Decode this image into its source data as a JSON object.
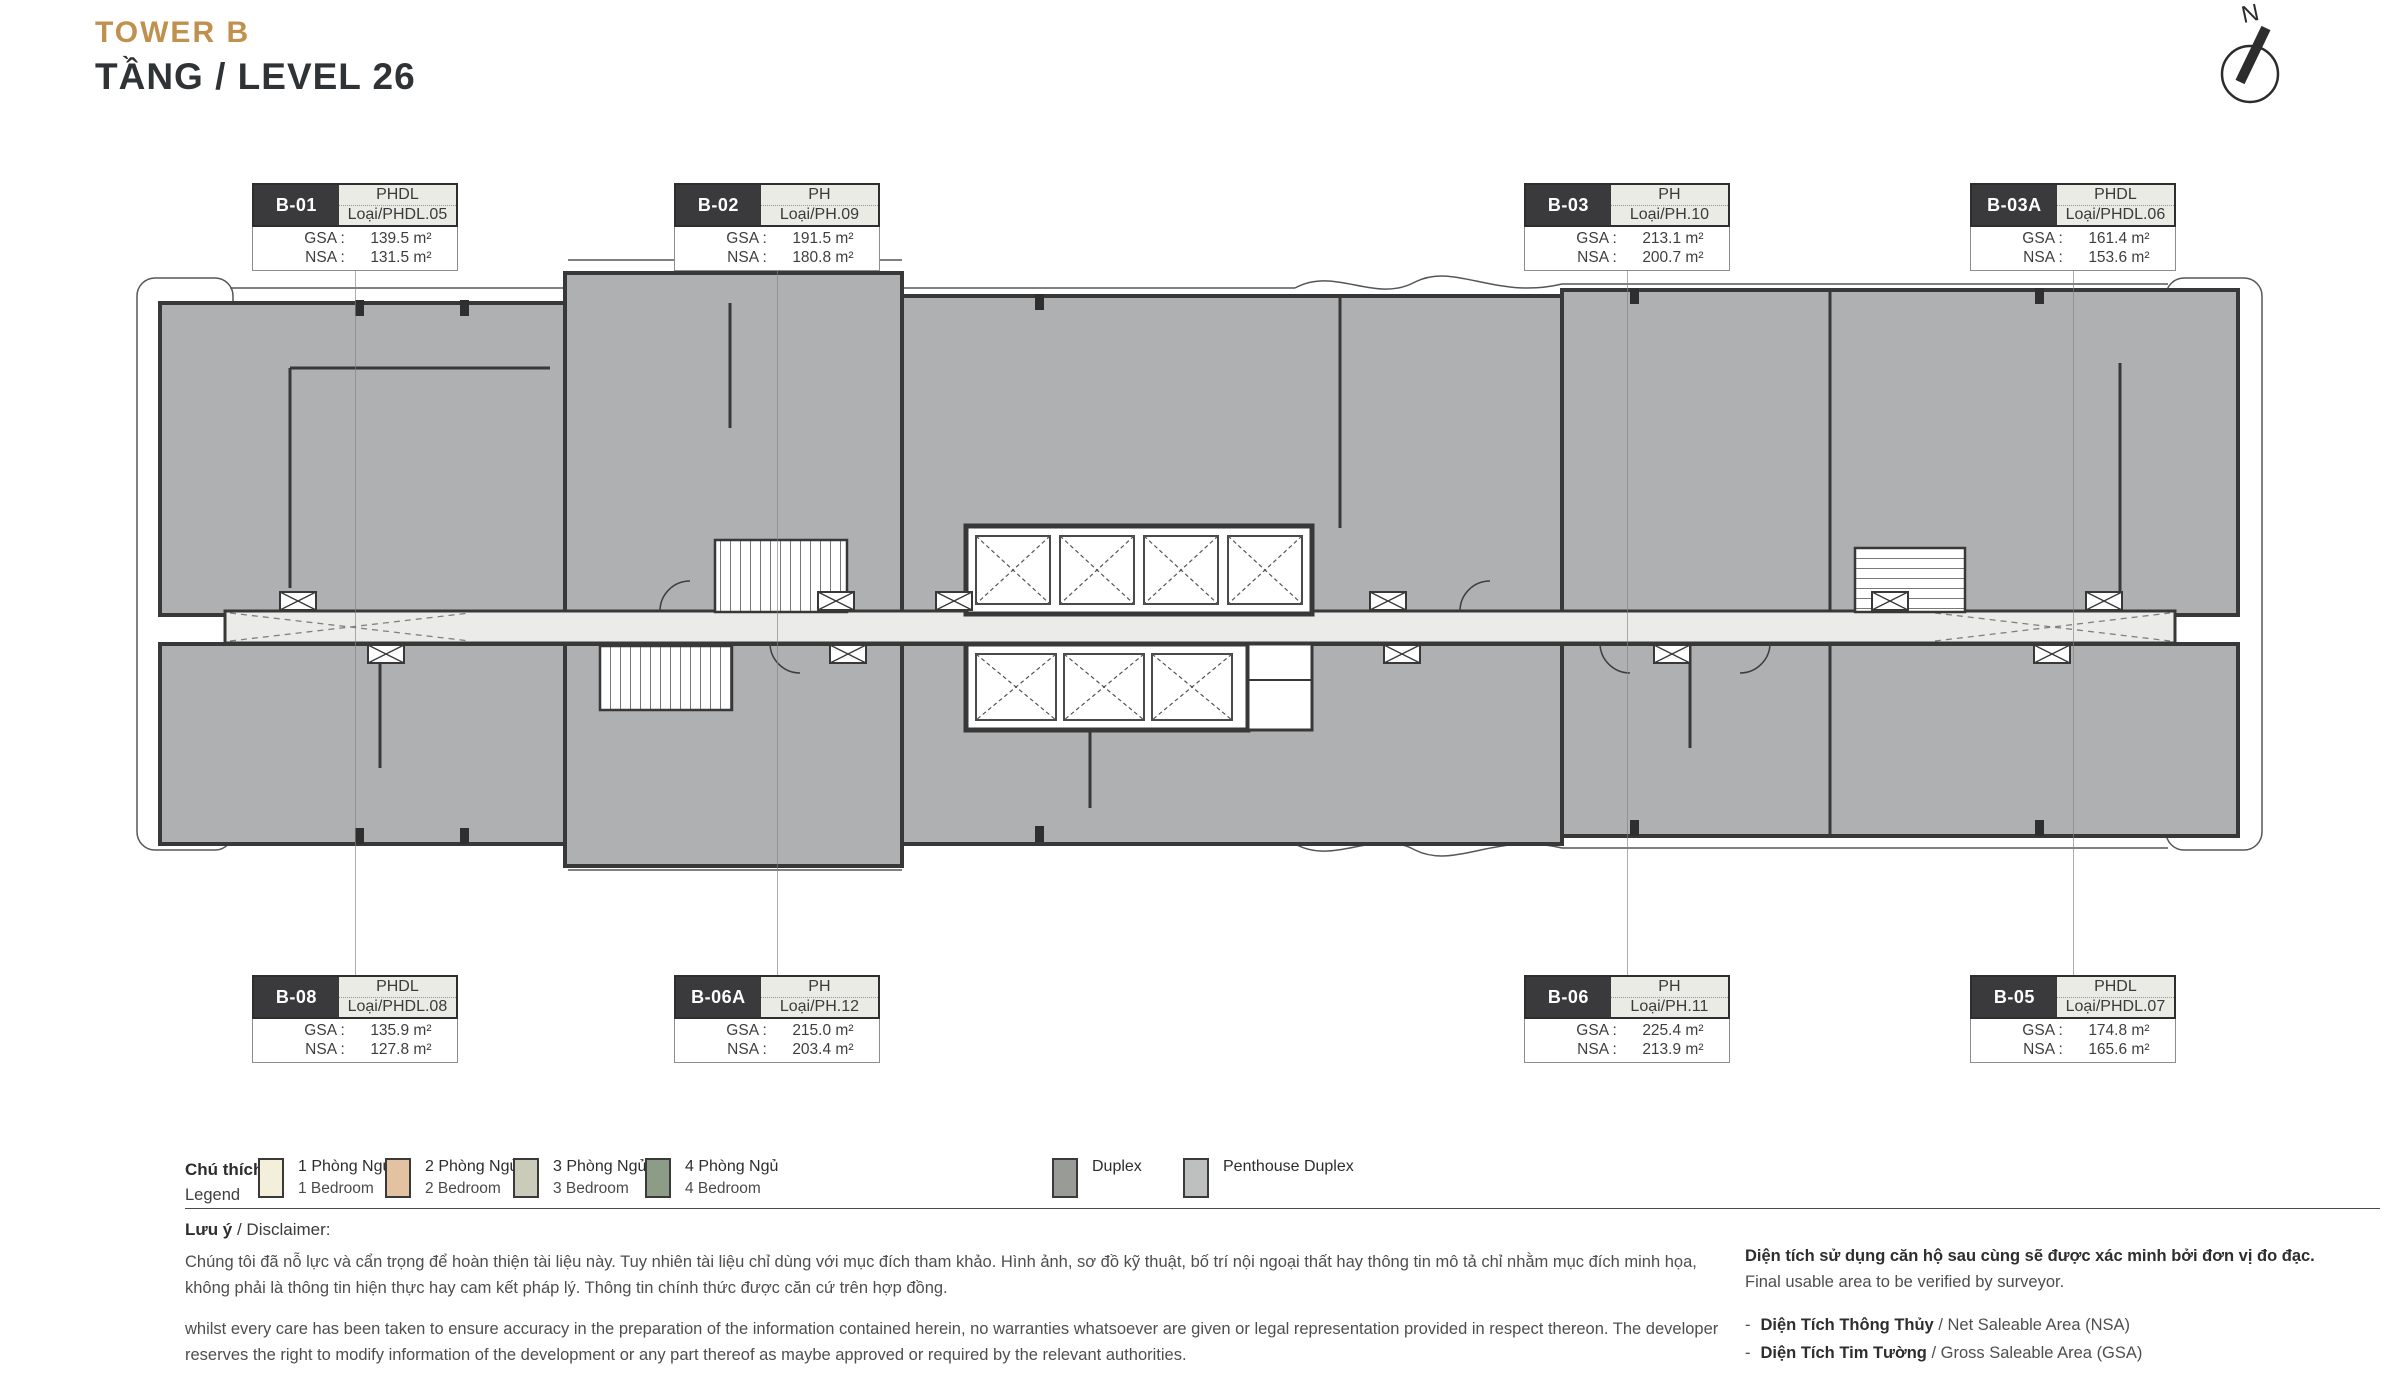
{
  "header": {
    "tower": "TOWER B",
    "level": "TẦNG / LEVEL 26"
  },
  "compass": {
    "label": "N"
  },
  "unit_labels": {
    "gsa": "GSA :",
    "nsa": "NSA :"
  },
  "units": [
    {
      "code": "B-01",
      "type": "PHDL",
      "type_detail": "Loại/PHDL.05",
      "gsa": "139.5 m²",
      "nsa": "131.5 m²"
    },
    {
      "code": "B-02",
      "type": "PH",
      "type_detail": "Loại/PH.09",
      "gsa": "191.5 m²",
      "nsa": "180.8 m²"
    },
    {
      "code": "B-03",
      "type": "PH",
      "type_detail": "Loại/PH.10",
      "gsa": "213.1 m²",
      "nsa": "200.7 m²"
    },
    {
      "code": "B-03A",
      "type": "PHDL",
      "type_detail": "Loại/PHDL.06",
      "gsa": "161.4 m²",
      "nsa": "153.6 m²"
    },
    {
      "code": "B-08",
      "type": "PHDL",
      "type_detail": "Loại/PHDL.08",
      "gsa": "135.9 m²",
      "nsa": "127.8 m²"
    },
    {
      "code": "B-06A",
      "type": "PH",
      "type_detail": "Loại/PH.12",
      "gsa": "215.0 m²",
      "nsa": "203.4 m²"
    },
    {
      "code": "B-06",
      "type": "PH",
      "type_detail": "Loại/PH.11",
      "gsa": "225.4 m²",
      "nsa": "213.9 m²"
    },
    {
      "code": "B-05",
      "type": "PHDL",
      "type_detail": "Loại/PHDL.07",
      "gsa": "174.8 m²",
      "nsa": "165.6 m²"
    }
  ],
  "legend": {
    "title_vi": "Chú thích",
    "title_en": "Legend",
    "items": [
      {
        "vi": "1 Phòng Ngủ",
        "en": "1 Bedroom",
        "color": "#F4EFDB"
      },
      {
        "vi": "2 Phòng Ngủ",
        "en": "2 Bedroom",
        "color": "#E2C2A0"
      },
      {
        "vi": "3 Phòng Ngủ",
        "en": "3 Bedroom",
        "color": "#CACBB8"
      },
      {
        "vi": "4 Phòng Ngủ",
        "en": "4 Bedroom",
        "color": "#8C9C86"
      },
      {
        "vi": "Duplex",
        "en": "",
        "color": "#999B97"
      },
      {
        "vi": "Penthouse Duplex",
        "en": "",
        "color": "#BEC0C0"
      }
    ]
  },
  "disclaimer": {
    "title_bold": "Lưu ý",
    "title_rest": " / Disclaimer:",
    "para_vi": "Chúng tôi đã nỗ lực và cẩn trọng để hoàn thiện tài liệu này. Tuy nhiên tài liệu chỉ dùng với mục đích tham khảo. Hình ảnh, sơ đồ kỹ thuật, bố trí nội ngoại thất hay thông tin mô tả chỉ nhằm mục đích minh họa, không phải là thông tin hiện thực hay cam kết pháp lý. Thông tin chính thức được căn cứ trên hợp đồng.",
    "para_en": "whilst every care has been taken to ensure accuracy in the preparation of the information contained herein, no warranties whatsoever are given or legal representation provided in respect thereon. The developer reserves the right to modify information of the development or any part thereof as maybe approved or required by the relevant authorities."
  },
  "area_note": {
    "line_bold_vi": "Diện tích sử dụng căn hộ sau cùng sẽ được xác minh bởi đơn vị đo đạc.",
    "line_en": "Final usable area to be verified by surveyor.",
    "bullets": [
      {
        "dash": "-",
        "vi": "Diện Tích Thông Thủy",
        "en": " / Net Saleable Area (NSA)"
      },
      {
        "dash": "-",
        "vi": "Diện Tích Tim Tường",
        "en": " / Gross Saleable Area (GSA)"
      }
    ]
  },
  "plan_colors": {
    "unit_fill": "#AEB0B2",
    "wall": "#383838",
    "corridor": "#EBEBE9",
    "accent": "#C0904F"
  }
}
